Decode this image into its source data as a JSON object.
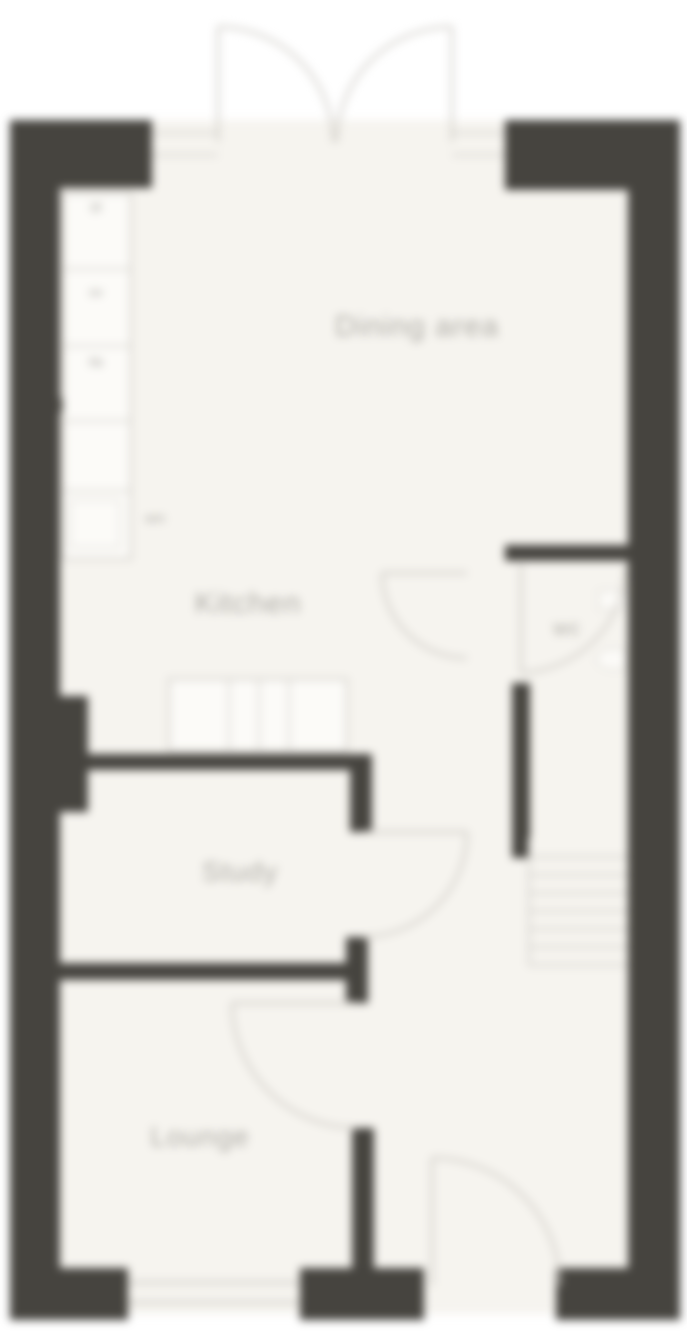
{
  "document": {
    "type": "floor-plan",
    "floor": "ground-floor"
  },
  "rooms": {
    "dining": {
      "label": "Dining area"
    },
    "kitchen": {
      "label": "Kitchen"
    },
    "study": {
      "label": "Study"
    },
    "lounge": {
      "label": "Lounge"
    },
    "wc": {
      "label": "wc"
    }
  },
  "kitchen_fixtures": {
    "fridge_freezer": "f/f",
    "oven": "ov",
    "hob": "hb",
    "washer": "wm"
  },
  "features": {
    "french_doors": "double outward swing, rear wall",
    "front_door": "single swing, bottom right",
    "window": "bottom wall, lounge",
    "stairs_treads": 6
  },
  "colors": {
    "wall": "#46443f",
    "floor": "#f6f4ef",
    "line": "#cfcdc8",
    "label": "#aeaca6",
    "background": "#ffffff"
  }
}
